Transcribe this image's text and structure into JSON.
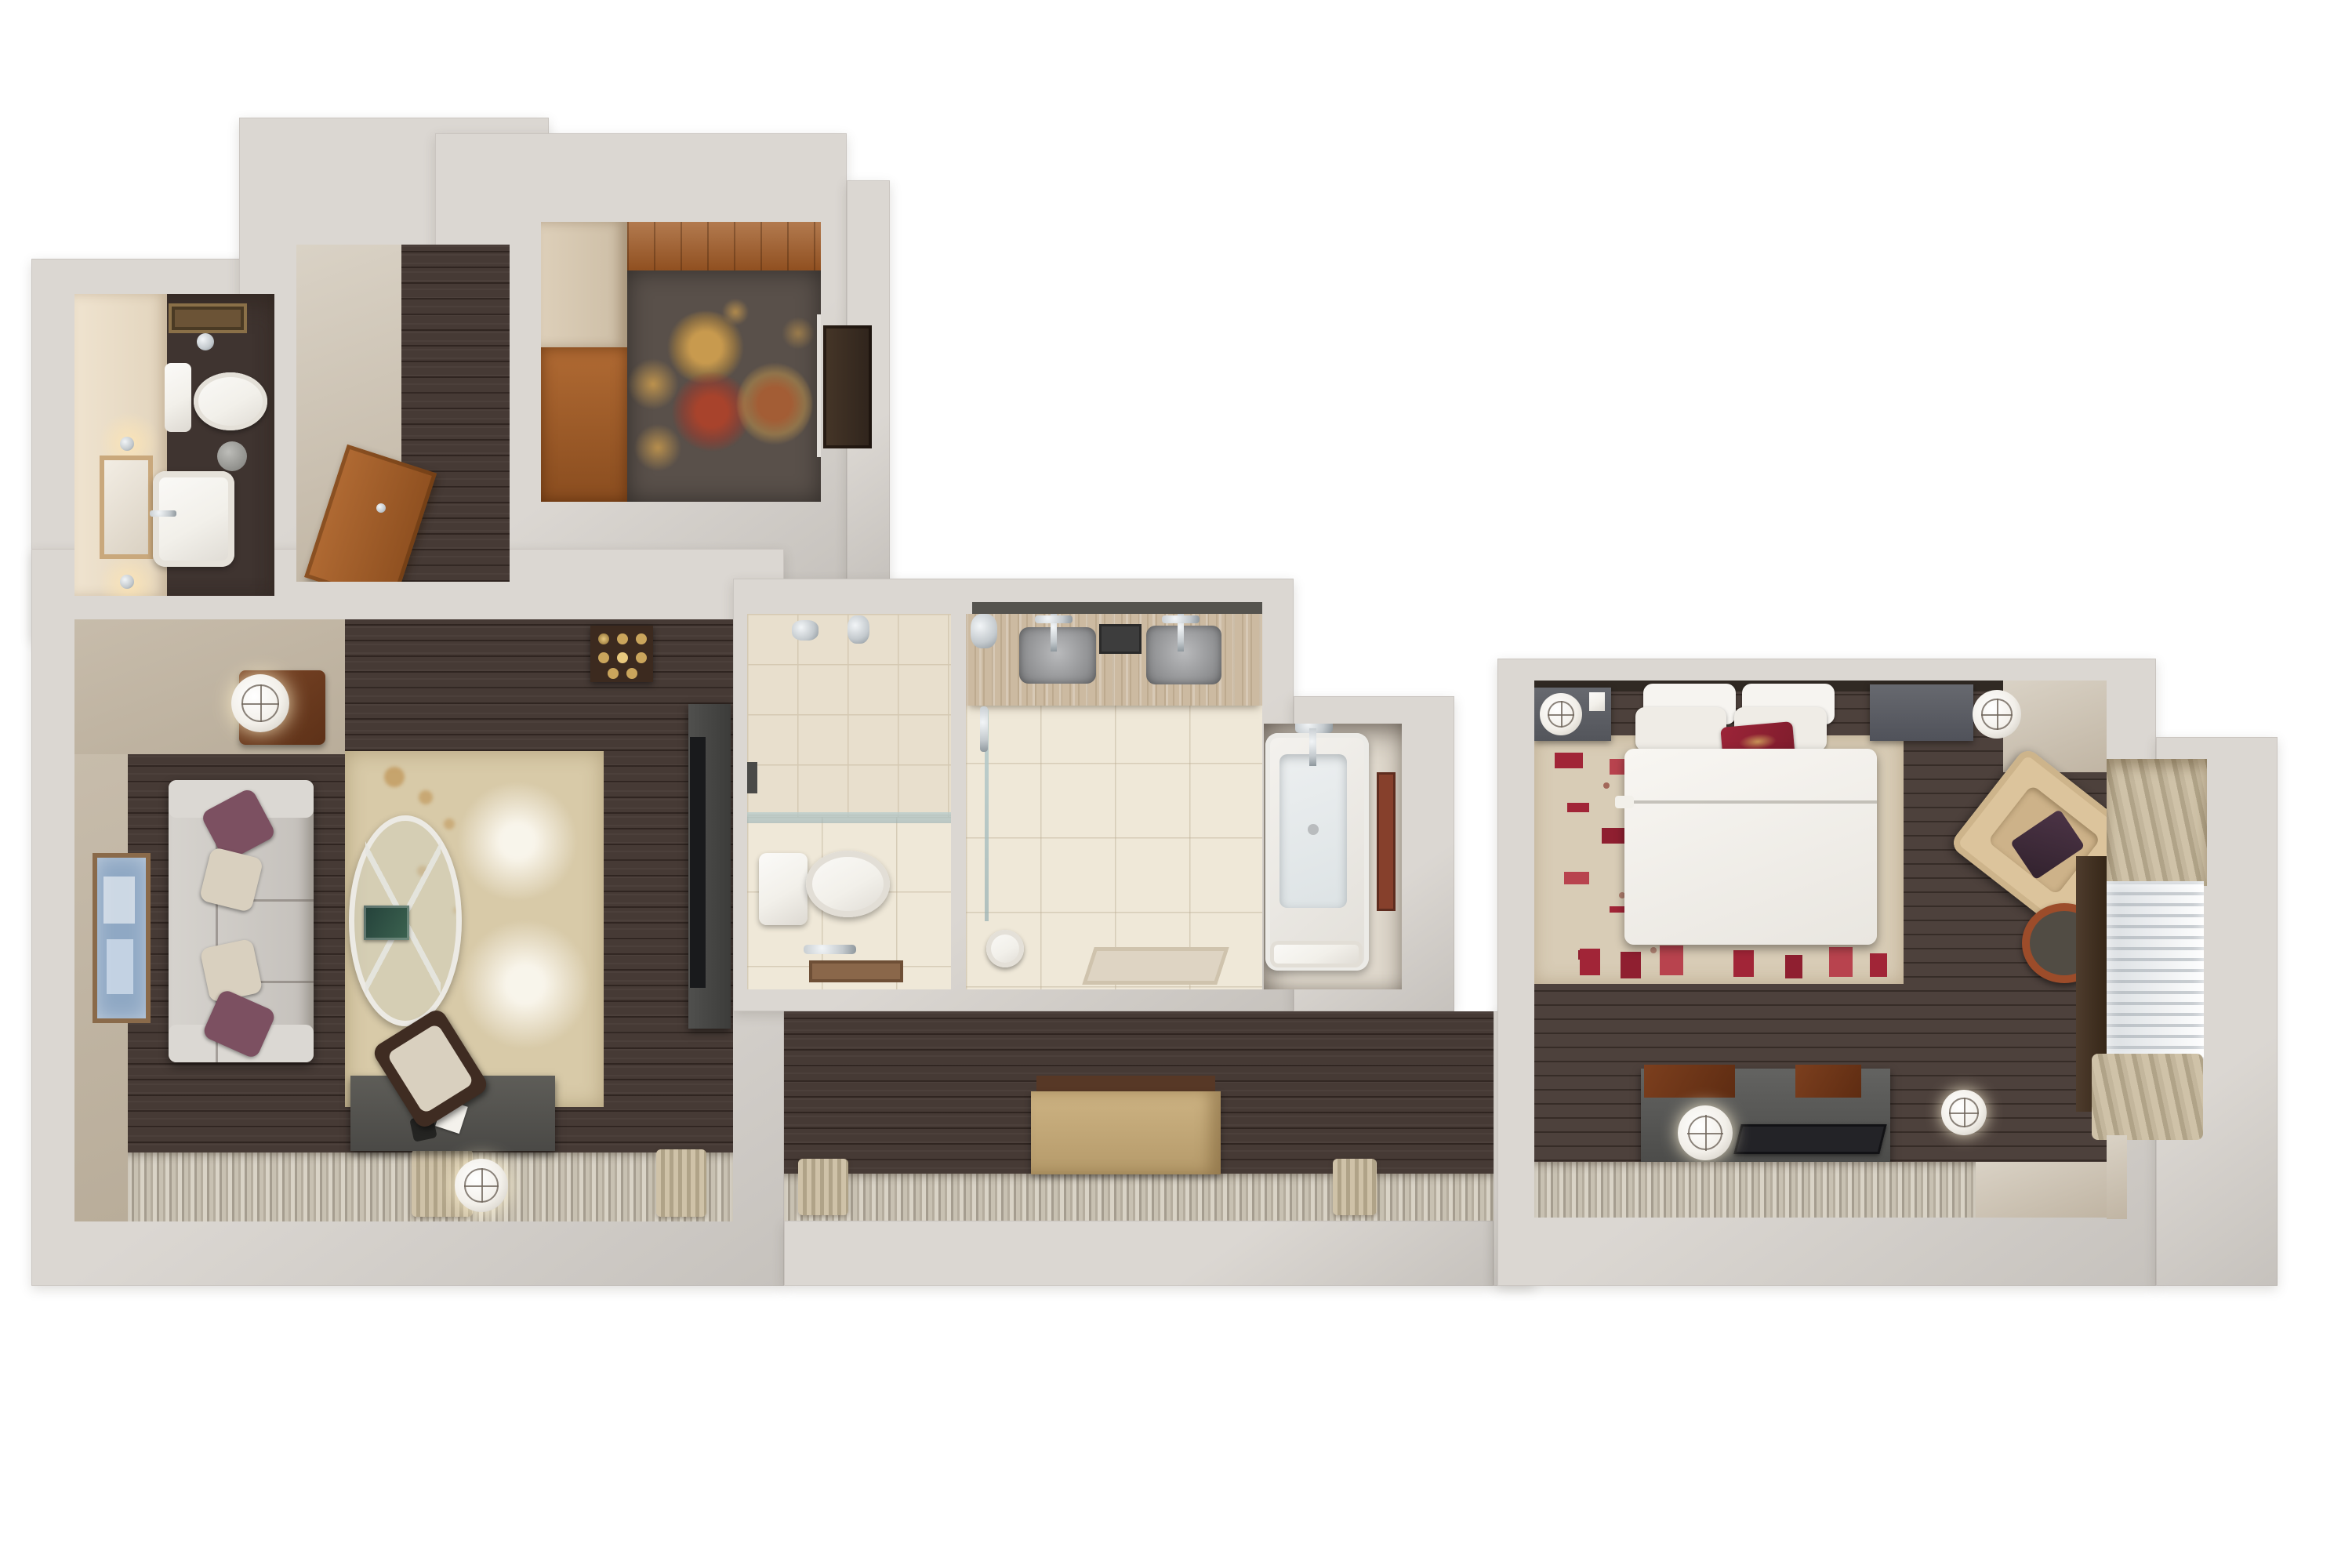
{
  "scene": {
    "kind": "3d-cutaway-floor-plan-rendering",
    "subject": "hotel-suite-top-down-dollhouse-view",
    "background": "#ffffff"
  },
  "palette": {
    "wall": "#dbd7d2",
    "wallShade": "#c6c2bd",
    "darkFloor": "#463a35",
    "bedFloor": "#4d413c",
    "tanFloor": "#cdc3b2",
    "greige": "#c7bcab",
    "wood": "#a25d28",
    "woodDark": "#6f3a1e",
    "tile": "#e8dfcd",
    "tileLine": "#d5c9b2",
    "tileLight": "#efe8d8",
    "travertine": "#ccbaa1",
    "chrome": "#c3c9cd",
    "white": "#f2f0ea",
    "sofa": "#ccc8c3",
    "pillowPurple": "#7c5061",
    "pillowCream": "#d9d0bf",
    "rugLiving": "#d8caa8",
    "rugFoyer": "#59504a",
    "gold": "#b3873e",
    "rust": "#9b3b2d",
    "rugBedroom": "#d8ccb6",
    "redAccent": "#a12537",
    "armchair": "#dcc49c",
    "gray": "#5c5c5a",
    "lamp": "#f2efe9",
    "curtA": "#cfc2a8",
    "curtB": "#b0a388",
    "drapeDark": "#443428",
    "sheer": "#eef1f3",
    "artBlue": "#8fa8c4",
    "artRust": "#86402c",
    "bench": "#c2a573",
    "mat": "#8a674a",
    "doorDark": "#3b2e24",
    "glass": "#cfdcd8"
  },
  "rooms": {
    "powder_room": {
      "label": "powder room",
      "items": [
        "toilet",
        "framed-art",
        "wall-sconce",
        "wall-sconce",
        "mirror",
        "pedestal-sink",
        "towel-ring",
        "waste-bin"
      ]
    },
    "entry_hall": {
      "label": "entry hall",
      "items": [
        "entry-door"
      ]
    },
    "foyer": {
      "label": "foyer",
      "items": [
        "area-rug-ornate",
        "closet-millwork",
        "interior-door"
      ]
    },
    "living_room": {
      "label": "living room",
      "items": [
        "sofa",
        "throw-pillows",
        "framed-art",
        "side-table",
        "table-lamp",
        "floral-area-rug",
        "oval-glass-coffee-table",
        "book",
        "minibar-tray-with-glasses",
        "media-console-tv",
        "writing-desk",
        "desk-chair",
        "desk-lamp",
        "telephone",
        "notepad",
        "window-sheers"
      ]
    },
    "water_closet": {
      "label": "water closet",
      "items": [
        "toilet",
        "glass-shelf",
        "towel-bar",
        "bath-mat",
        "wall-sconce",
        "wall-sconce",
        "light-switch"
      ]
    },
    "bathroom": {
      "label": "main bathroom",
      "items": [
        "double-vanity",
        "vessel-sink",
        "vessel-sink",
        "faucet",
        "faucet",
        "amenity-tray",
        "walk-in-shower",
        "shower-glass-door",
        "hand-shower",
        "rolled-towel",
        "bath-mat"
      ]
    },
    "tub_alcove": {
      "label": "soaking tub alcove",
      "items": [
        "soaking-tub",
        "tub-filler",
        "rolled-towels",
        "framed-art"
      ]
    },
    "corridor": {
      "label": "corridor",
      "items": [
        "upholstered-bench",
        "window-sheers",
        "curtain-panels"
      ]
    },
    "bedroom": {
      "label": "bedroom",
      "items": [
        "king-bed",
        "pillows",
        "red-accent-pillow",
        "area-rug-patterned",
        "nightstand",
        "nightstand",
        "orb-clock",
        "orb-lamp",
        "lounge-armchair",
        "accent-pillow",
        "round-side-table",
        "media-console",
        "flat-tv",
        "orb-lamp",
        "luggage-trays",
        "floor-orb-lamp",
        "dressing-nook",
        "blackout-drape",
        "pleated-drapes",
        "sheer-window",
        "window-sheers"
      ]
    }
  }
}
